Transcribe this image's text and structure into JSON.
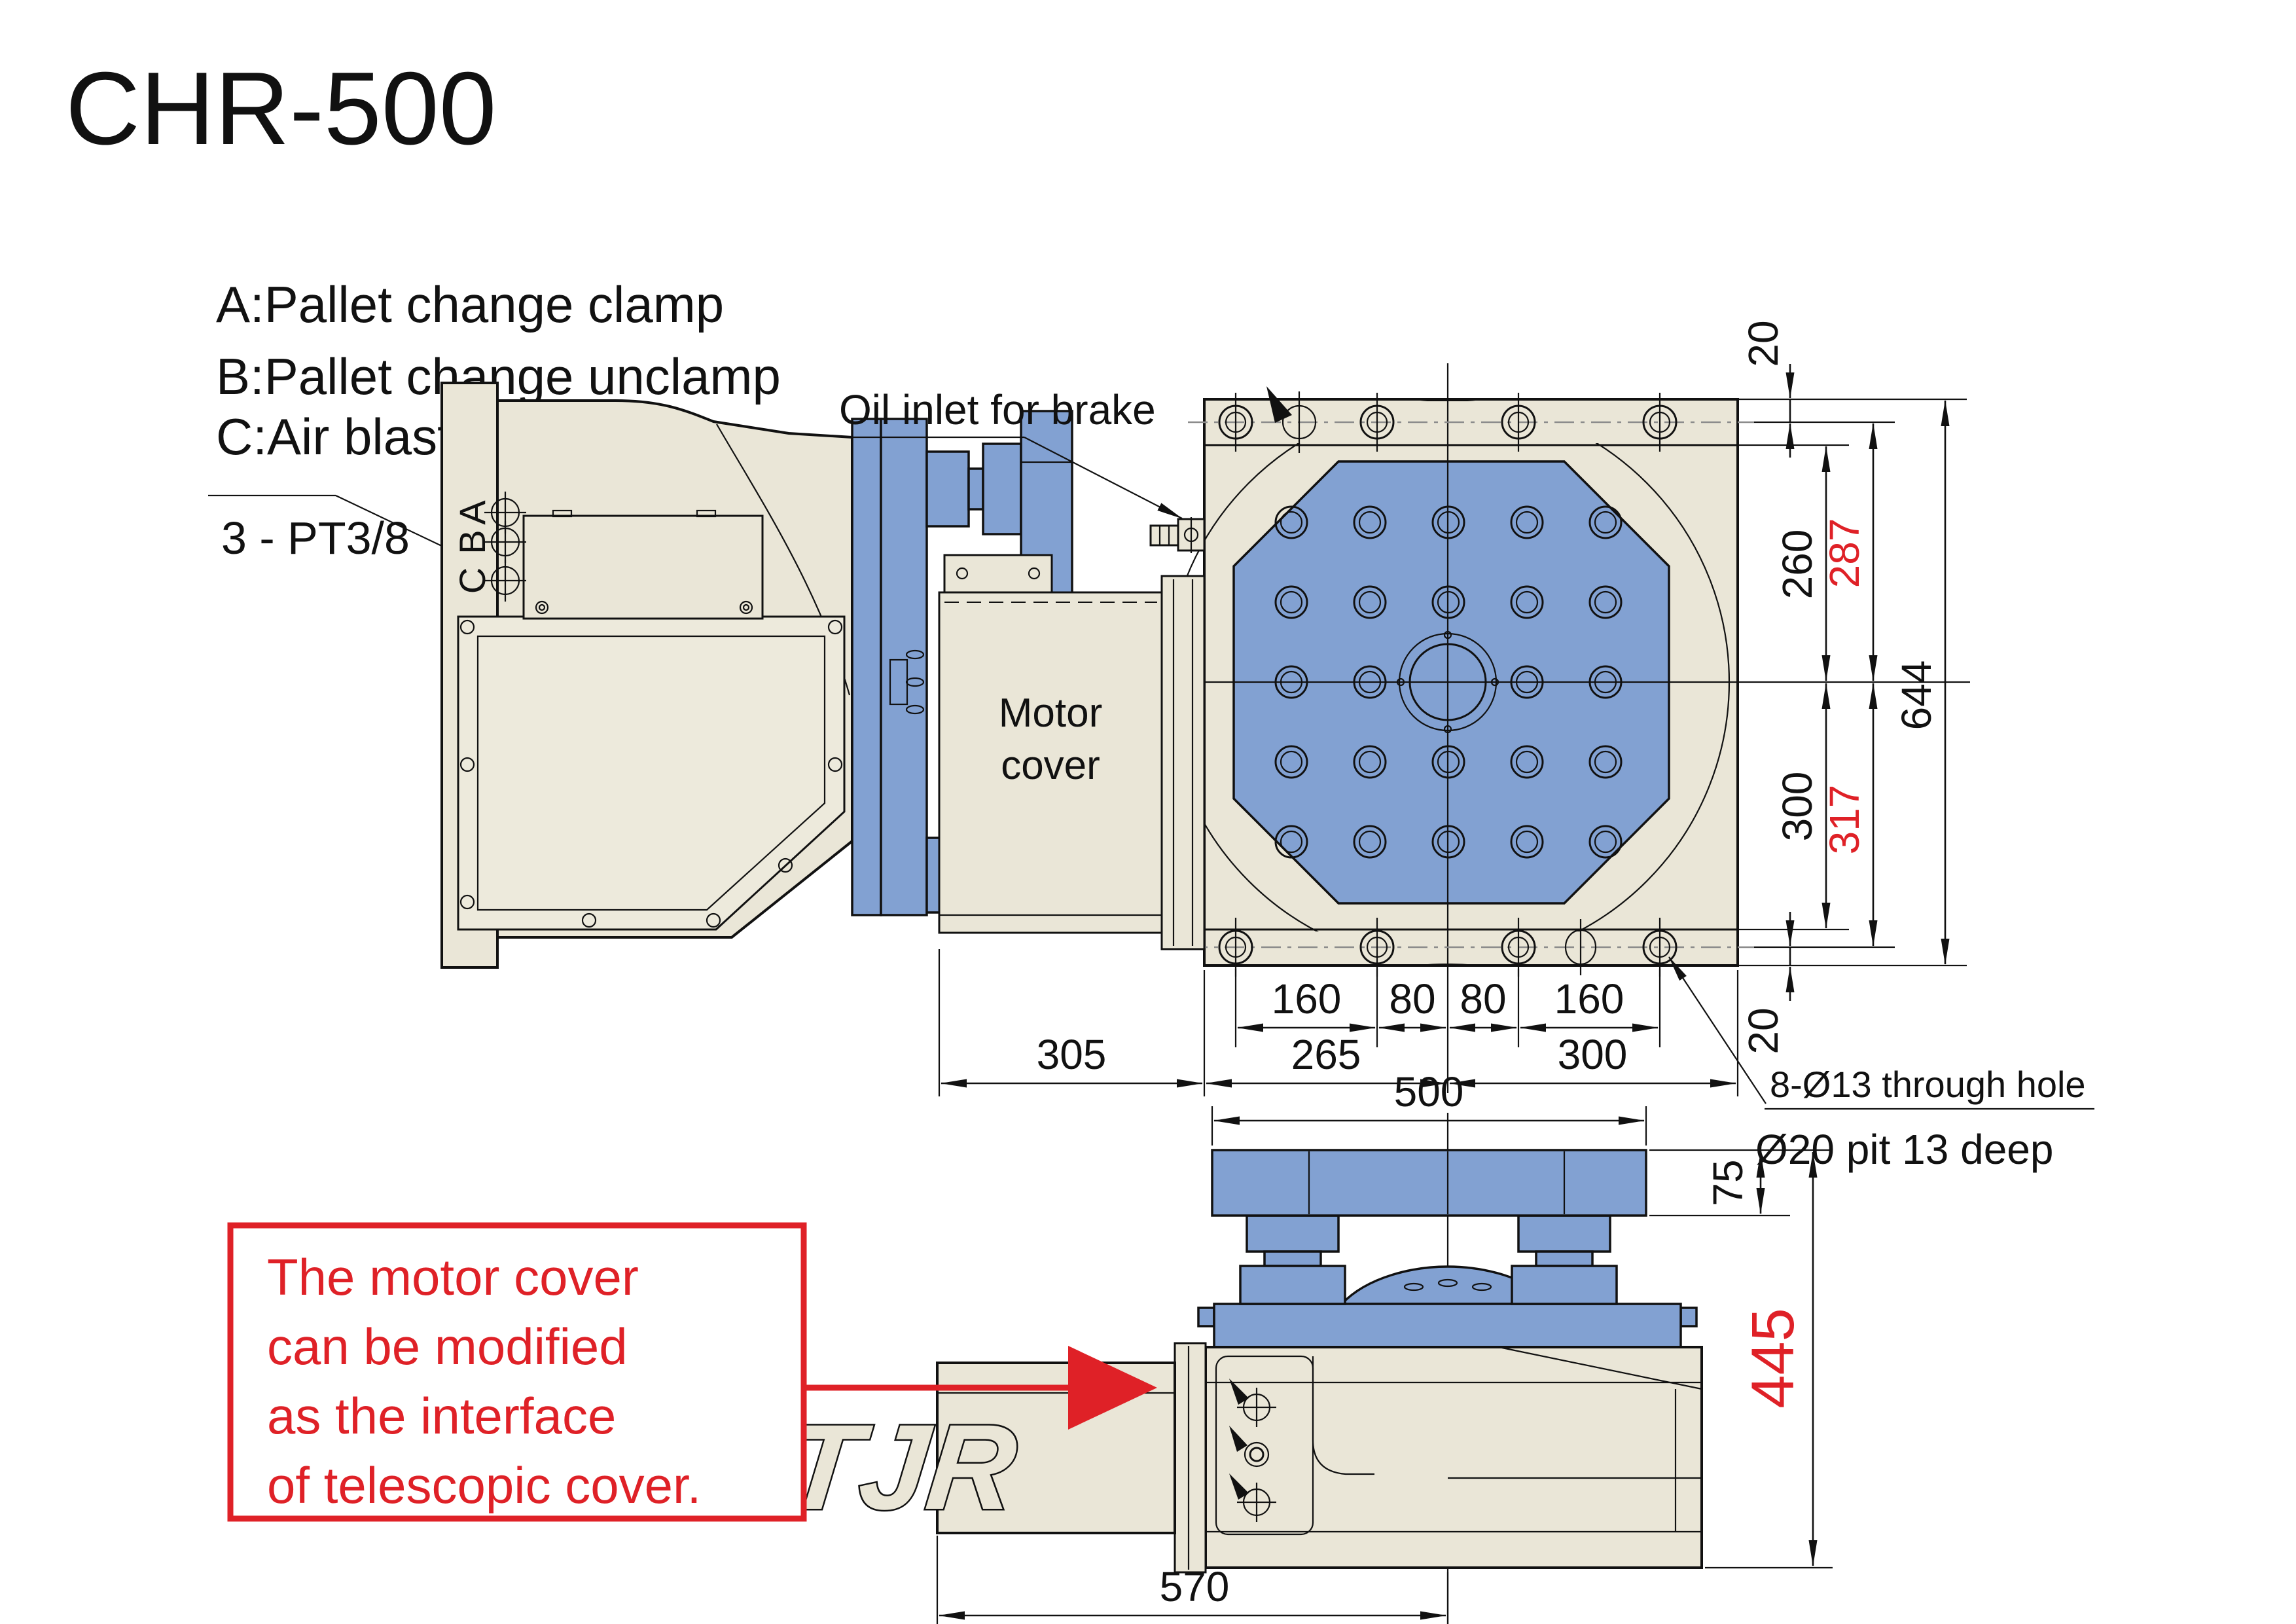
{
  "title": "CHR-500",
  "legend": {
    "a": "A:Pallet change clamp",
    "b": "B:Pallet change unclamp",
    "c": "C:Air blast",
    "port_note": "3 - PT3/8"
  },
  "callouts": {
    "oil_inlet": "Oil inlet for brake",
    "hole_note1": "8-Ø13 through hole",
    "hole_note2": "Ø20 pit 13 deep"
  },
  "motor_cover": {
    "line1": "Motor",
    "line2": "cover"
  },
  "brand": "TJR",
  "ports": {
    "a": "A",
    "b": "B",
    "c": "C"
  },
  "note_box": {
    "line1": "The motor cover",
    "line2": "can be modified",
    "line3": "as the interface",
    "line4": "of telescopic cover."
  },
  "dims": {
    "top_margin": "20",
    "top_holes_inner": "260",
    "top_holes_red": "287",
    "overall_height_plan": "644",
    "bottom_holes_inner": "300",
    "bottom_holes_red": "317",
    "bottom_margin": "20",
    "holes_160_left": "160",
    "holes_80_left": "80",
    "holes_80_right": "80",
    "holes_160_right": "160",
    "motor_cover_width": "305",
    "center_left": "265",
    "center_right": "300",
    "pallet_width": "500",
    "pallet_thickness": "75",
    "overall_height_front": "445",
    "body_width": "570"
  },
  "colors": {
    "body_beige": "#EAE6D7",
    "pallet_blue": "#82A1D2",
    "accent_red": "#DF2127",
    "line": "#111111",
    "centerline": "#8C8C8C"
  }
}
